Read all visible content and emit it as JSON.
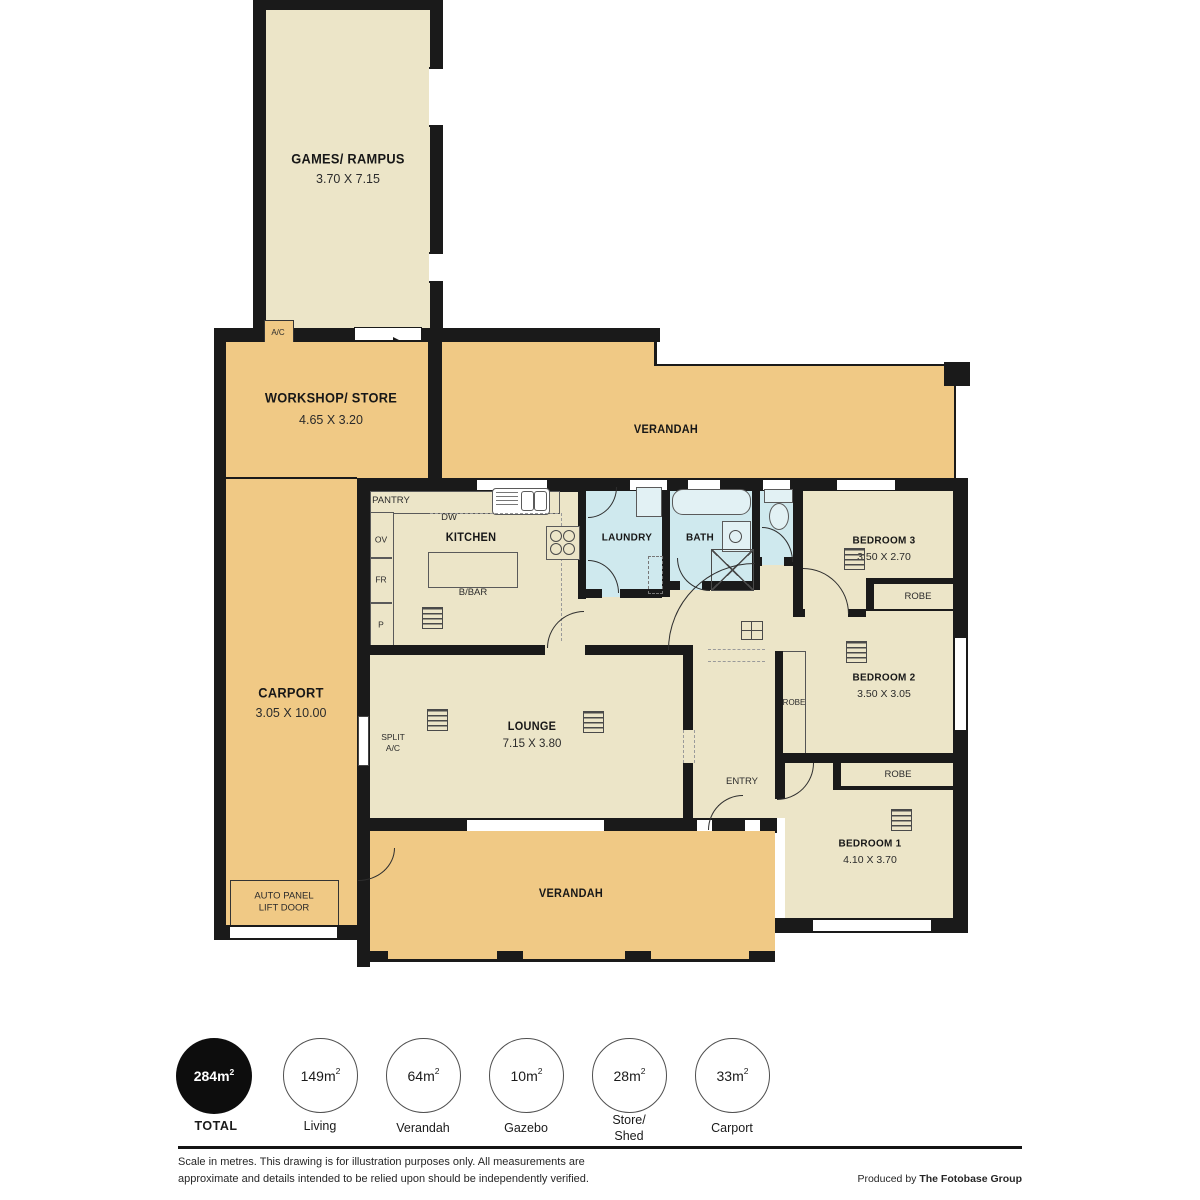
{
  "rooms": {
    "games": {
      "name": "GAMES/ RAMPUS",
      "dims": "3.70 X 7.15"
    },
    "workshop": {
      "name": "WORKSHOP/ STORE",
      "dims": "4.65 X 3.20"
    },
    "verandah_top": {
      "name": "VERANDAH"
    },
    "carport": {
      "name": "CARPORT",
      "dims": "3.05 X 10.00"
    },
    "kitchen": {
      "name": "KITCHEN"
    },
    "laundry": {
      "name": "LAUNDRY"
    },
    "bath": {
      "name": "BATH"
    },
    "bedroom3": {
      "name": "BEDROOM 3",
      "dims": "3.50 X 2.70"
    },
    "bedroom2": {
      "name": "BEDROOM 2",
      "dims": "3.50 X 3.05"
    },
    "bedroom1": {
      "name": "BEDROOM 1",
      "dims": "4.10 X 3.70"
    },
    "lounge": {
      "name": "LOUNGE",
      "dims": "7.15 X 3.80"
    },
    "entry": {
      "name": "ENTRY"
    },
    "verandah_bottom": {
      "name": "VERANDAH"
    }
  },
  "fixtures": {
    "pantry": "PANTRY",
    "dw": "DW",
    "ov": "OV",
    "fr": "FR",
    "p": "P",
    "bbar": "B/BAR",
    "robe": "ROBE",
    "split_ac": "SPLIT\nA/C",
    "ac": "A/C",
    "auto_panel": "AUTO PANEL\nLIFT DOOR"
  },
  "summary": {
    "items": [
      {
        "value": "284m",
        "sup": "2",
        "label": "TOTAL"
      },
      {
        "value": "149m",
        "sup": "2",
        "label": "Living"
      },
      {
        "value": "64m",
        "sup": "2",
        "label": "Verandah"
      },
      {
        "value": "10m",
        "sup": "2",
        "label": "Gazebo"
      },
      {
        "value": "28m",
        "sup": "2",
        "label": "Store/\nShed"
      },
      {
        "value": "33m",
        "sup": "2",
        "label": "Carport"
      }
    ]
  },
  "footer": {
    "disclaimer_line1": "Scale in metres. This drawing is for illustration purposes only. All measurements are",
    "disclaimer_line2": "approximate and details intended to be relied upon should be independently verified.",
    "produced_by": "Produced by ",
    "brand": "The Fotobase Group"
  },
  "colors": {
    "verandah_tan": "#f0c985",
    "room_cream": "#ece5c8",
    "wet_area_blue": "#cfe9ee",
    "wall_black": "#1a1a1a"
  }
}
